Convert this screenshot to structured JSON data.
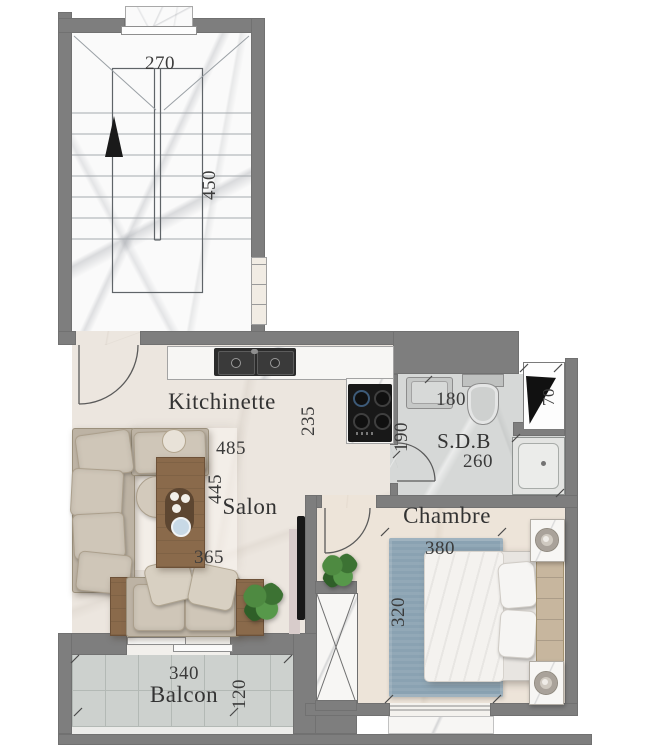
{
  "floor_plan": {
    "staircase": {
      "width_label": "270",
      "depth_label": "450"
    },
    "kitchinette": {
      "name": "Kitchinette",
      "width_label": "485",
      "depth_label": "235"
    },
    "salon": {
      "name": "Salon",
      "depth_label": "445",
      "width_label": "365"
    },
    "sdb": {
      "name": "S.D.B",
      "width_label": "260",
      "vanity_label": "180",
      "entry_label": "190"
    },
    "duct": {
      "width_label": "70"
    },
    "chambre": {
      "name": "Chambre",
      "width_label": "380",
      "depth_label": "320"
    },
    "balcon": {
      "name": "Balcon",
      "width_label": "340",
      "depth_label": "120"
    }
  },
  "colors": {
    "wall": "#7e7e7e",
    "living_floor": "#ece6df",
    "bathroom_floor": "#d6d8d7",
    "balcony_tile": "#cdd1ce",
    "bedroom_rug": "#8aa2b2",
    "wood": "#8a6a4b",
    "plant": "#4e8a41",
    "cooktop": "#181818",
    "label_text": "#3b3b3b"
  }
}
